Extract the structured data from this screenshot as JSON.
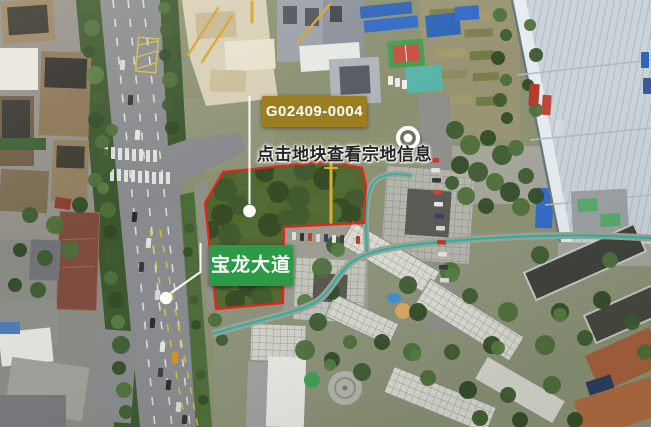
{
  "map_overlay": {
    "parcel": {
      "id": "G02409-0004",
      "hint": "点击地块查看宗地信息",
      "outline_points": "223,172 330,161 362,168 366,186 364,223 284,227 283,303 216,309 205,203",
      "outline_color": "#e8231d",
      "label_bg": "#9c7d20",
      "label_text_color": "#ffffff"
    },
    "road": {
      "name": "宝龙大道",
      "label_bg": "#2c9a47",
      "label_text_color": "#ffffff"
    },
    "marker_icon": {
      "name": "location-ring-dot-icon",
      "color": "#ffffff"
    }
  }
}
